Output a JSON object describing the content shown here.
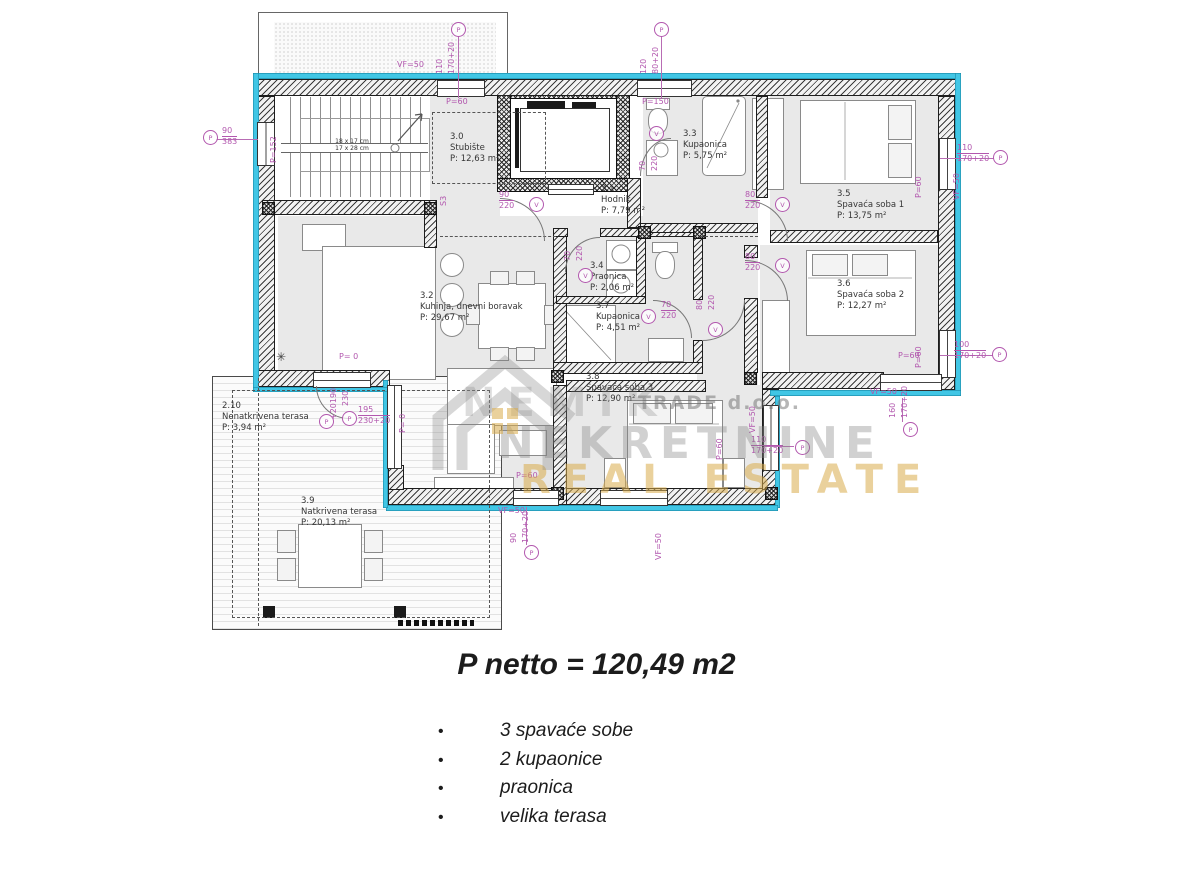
{
  "plan": {
    "rooms": [
      {
        "id": "3.0",
        "name": "Stubište",
        "area": "P: 12,63 m²",
        "x": 450,
        "y": 132
      },
      {
        "id": "3.1",
        "name": "Hodnik",
        "area": "P: 7,79 m²",
        "x": 601,
        "y": 184
      },
      {
        "id": "3.2",
        "name": "Kuhinja, dnevni boravak",
        "area": "P: 29,67 m²",
        "x": 420,
        "y": 291
      },
      {
        "id": "3.3",
        "name": "Kupaonica",
        "area": "P: 5,75 m²",
        "x": 683,
        "y": 129
      },
      {
        "id": "3.4",
        "name": "Praonica",
        "area": "P: 2,06 m²",
        "x": 590,
        "y": 261
      },
      {
        "id": "3.5",
        "name": "Spavaća soba 1",
        "area": "P: 13,75 m²",
        "x": 837,
        "y": 189
      },
      {
        "id": "3.6",
        "name": "Spavaća soba 2",
        "area": "P: 12,27 m²",
        "x": 837,
        "y": 279
      },
      {
        "id": "3.7",
        "name": "Kupaonica",
        "area": "P: 4,51 m²",
        "x": 596,
        "y": 301
      },
      {
        "id": "3.8",
        "name": "Spavaća soba 3",
        "area": "P: 12,90 m²",
        "x": 586,
        "y": 372
      },
      {
        "id": "3.9",
        "name": "Natkrivena terasa",
        "area": "P: 20,13 m²",
        "x": 301,
        "y": 496
      },
      {
        "id": "2.10",
        "name": "Nenatkrivena terasa",
        "area": "P: 3,94 m²",
        "x": 222,
        "y": 401
      }
    ],
    "dims": [
      {
        "t": "VF=50",
        "x": 397,
        "y": 60
      },
      {
        "t": "110",
        "x": 444,
        "y": 74,
        "v": 1
      },
      {
        "t": "170+20",
        "x": 456,
        "y": 74,
        "v": 1
      },
      {
        "t": "120",
        "x": 648,
        "y": 74,
        "v": 1
      },
      {
        "t": "80+20",
        "x": 660,
        "y": 74,
        "v": 1
      },
      {
        "t": "P=60",
        "x": 446,
        "y": 97
      },
      {
        "t": "P=150",
        "x": 642,
        "y": 97
      },
      {
        "t": "90",
        "t2": "383",
        "x": 222,
        "y": 126,
        "frac": 1
      },
      {
        "t": "P=152",
        "x": 278,
        "y": 163,
        "v": 1
      },
      {
        "t": "90",
        "t2": "220",
        "x": 499,
        "y": 190,
        "frac": 1
      },
      {
        "t": "70",
        "x": 647,
        "y": 171,
        "v": 1
      },
      {
        "t": "220",
        "x": 659,
        "y": 171,
        "v": 1
      },
      {
        "t": "80",
        "t2": "220",
        "x": 745,
        "y": 190,
        "frac": 1
      },
      {
        "t": "80",
        "t2": "220",
        "x": 745,
        "y": 252,
        "frac": 1
      },
      {
        "t": "80",
        "x": 704,
        "y": 310,
        "v": 1
      },
      {
        "t": "220",
        "x": 716,
        "y": 310,
        "v": 1
      },
      {
        "t": "70",
        "x": 572,
        "y": 261,
        "v": 1
      },
      {
        "t": "220",
        "x": 584,
        "y": 261,
        "v": 1
      },
      {
        "t": "70",
        "t2": "220",
        "x": 661,
        "y": 300,
        "frac": 1
      },
      {
        "t": "P=60",
        "x": 923,
        "y": 198,
        "v": 1
      },
      {
        "t": "110",
        "t2": "170+20",
        "x": 957,
        "y": 143,
        "frac": 1
      },
      {
        "t": "VF=50",
        "x": 961,
        "y": 200,
        "v": 1
      },
      {
        "t": "P=60",
        "x": 898,
        "y": 351
      },
      {
        "t": "P=60",
        "x": 923,
        "y": 368,
        "v": 1
      },
      {
        "t": "100",
        "t2": "170+20",
        "x": 954,
        "y": 340,
        "frac": 1
      },
      {
        "t": "VF=50",
        "x": 870,
        "y": 387
      },
      {
        "t": "160",
        "x": 897,
        "y": 418,
        "v": 1
      },
      {
        "t": "170+20",
        "x": 909,
        "y": 418,
        "v": 1
      },
      {
        "t": "VF=50",
        "x": 757,
        "y": 433,
        "v": 1
      },
      {
        "t": "P=60",
        "x": 724,
        "y": 460,
        "v": 1
      },
      {
        "t": "110",
        "t2": "170+20",
        "x": 751,
        "y": 435,
        "frac": 1
      },
      {
        "t": "P=60",
        "x": 516,
        "y": 471
      },
      {
        "t": "VF=50",
        "x": 498,
        "y": 506
      },
      {
        "t": "90",
        "x": 518,
        "y": 543,
        "v": 1
      },
      {
        "t": "170+20",
        "x": 530,
        "y": 543,
        "v": 1
      },
      {
        "t": "VF=50",
        "x": 663,
        "y": 560,
        "v": 1
      },
      {
        "t": "P= 0",
        "x": 339,
        "y": 352
      },
      {
        "t": "+20190",
        "x": 338,
        "y": 420,
        "v": 1
      },
      {
        "t": "230",
        "x": 350,
        "y": 406,
        "v": 1
      },
      {
        "t": "195",
        "t2": "230+20",
        "x": 358,
        "y": 405,
        "frac": 1
      },
      {
        "t": "P= 0",
        "x": 407,
        "y": 433,
        "v": 1
      },
      {
        "t": "S3",
        "x": 448,
        "y": 206,
        "v": 1
      }
    ],
    "markers": [
      {
        "t": "P",
        "x": 451,
        "y": 22
      },
      {
        "t": "P",
        "x": 654,
        "y": 22
      },
      {
        "t": "P",
        "x": 203,
        "y": 130
      },
      {
        "t": "P",
        "x": 993,
        "y": 150
      },
      {
        "t": "P",
        "x": 992,
        "y": 347
      },
      {
        "t": "P",
        "x": 903,
        "y": 422
      },
      {
        "t": "P",
        "x": 795,
        "y": 440
      },
      {
        "t": "P",
        "x": 524,
        "y": 545
      },
      {
        "t": "P",
        "x": 319,
        "y": 414
      },
      {
        "t": "P",
        "x": 342,
        "y": 411
      },
      {
        "t": "V",
        "x": 529,
        "y": 197
      },
      {
        "t": "V",
        "x": 649,
        "y": 126
      },
      {
        "t": "V",
        "x": 775,
        "y": 197
      },
      {
        "t": "V",
        "x": 775,
        "y": 258
      },
      {
        "t": "V",
        "x": 708,
        "y": 322
      },
      {
        "t": "V",
        "x": 578,
        "y": 268
      },
      {
        "t": "V",
        "x": 641,
        "y": 309
      }
    ],
    "stair_note": {
      "l1": "18 x 17 cm",
      "l2": "17 x 28 cm"
    },
    "watermark": {
      "company": "NEMIK",
      "company2": "TRADE d.o.o.",
      "line2": "NEKRETNINE",
      "line3": "REAL ESTATE"
    }
  },
  "summary": {
    "title": "P netto = 120,49 m2",
    "bullets": [
      "3 spavaće sobe",
      "2 kupaonice",
      "praonica",
      "velika terasa"
    ]
  },
  "colors": {
    "dimension": "#b257ae",
    "exterior_highlight": "#41c6e5",
    "wall": "#1d1d1d",
    "room_fill": "#e9e9e9",
    "watermark_gold": "#d8ac4a"
  }
}
